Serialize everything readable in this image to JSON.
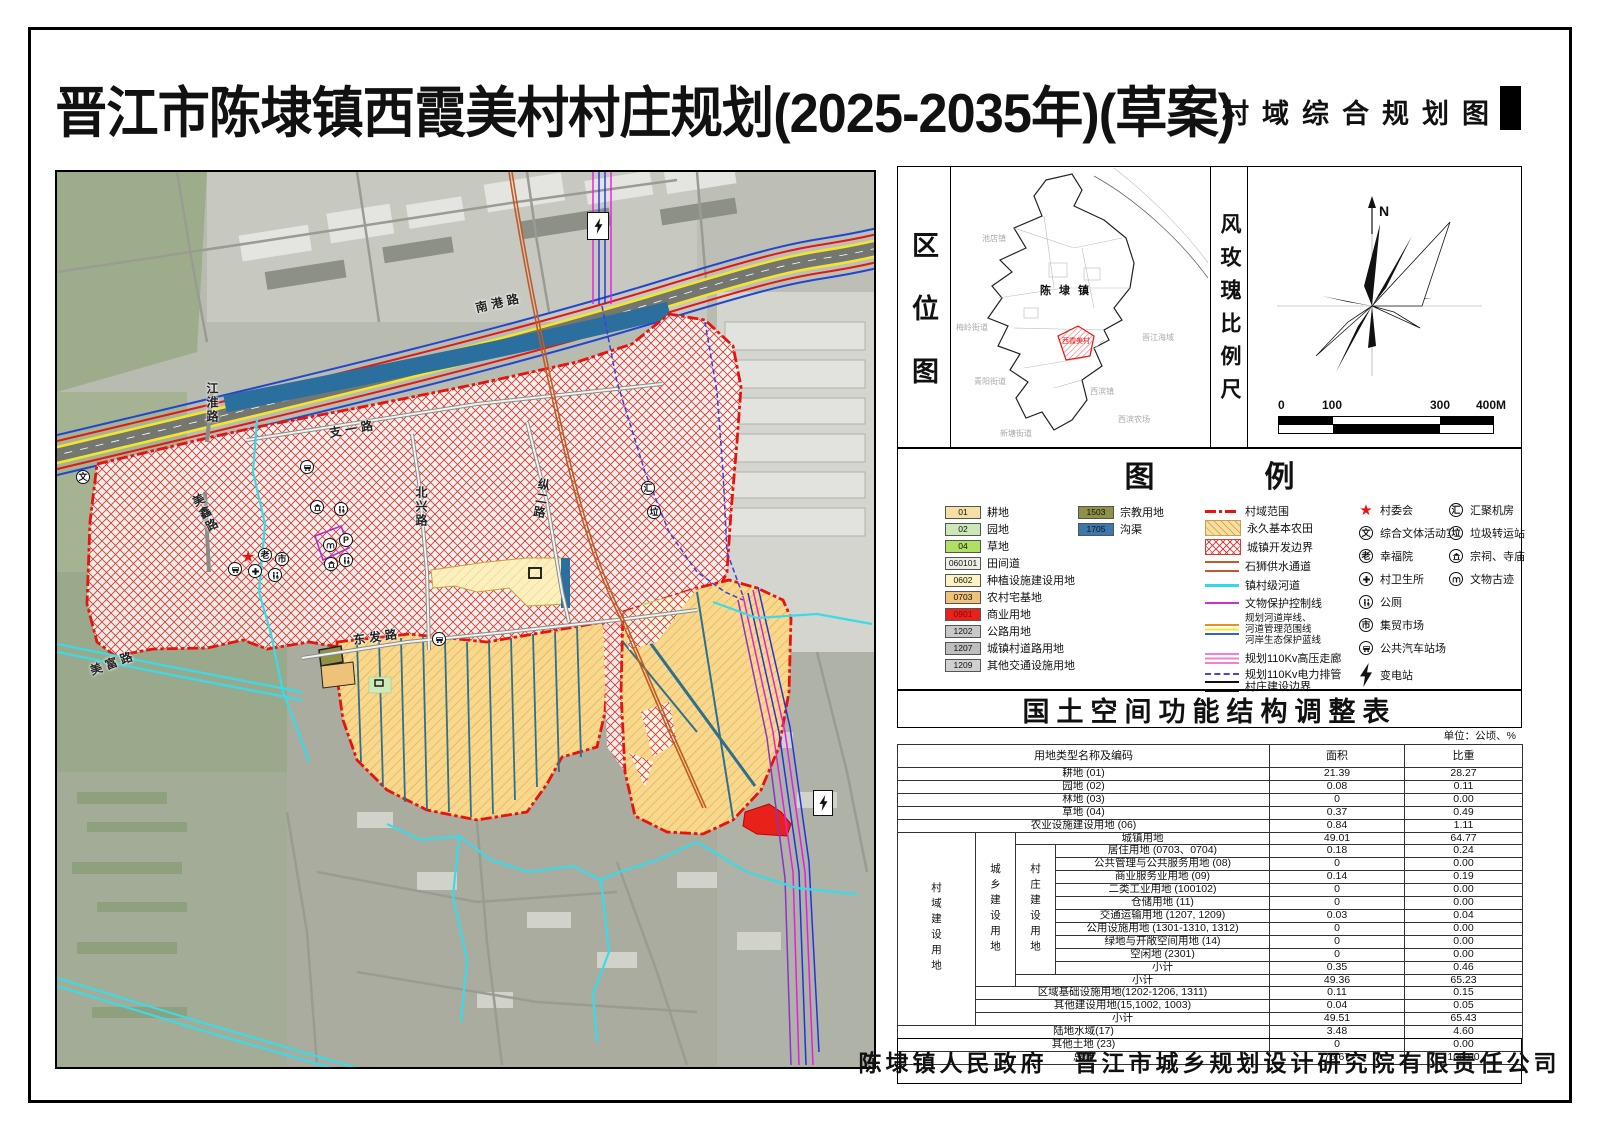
{
  "header": {
    "main_title": "晋江市陈埭镇西霞美村村庄规划(2025-2035年)(草案)",
    "sheet_title": "村域综合规划图"
  },
  "location_panel": {
    "label": "区位图",
    "town_label": "陈埭镇",
    "village_label": "西霞美村",
    "neighbors": [
      "池店镇",
      "梅岭街道",
      "青阳街道",
      "新塘街道",
      "西滨镇",
      "晋江海域",
      "西滨农场"
    ]
  },
  "compass_panel": {
    "label": "风玫瑰比例尺",
    "north_label": "N",
    "scale_ticks": [
      "0",
      "100",
      "300",
      "400M"
    ]
  },
  "legend": {
    "title": "图例",
    "land_items": [
      {
        "code": "01",
        "label": "耕地",
        "color": "#F6DFA4"
      },
      {
        "code": "02",
        "label": "园地",
        "color": "#CBE8B9"
      },
      {
        "code": "04",
        "label": "草地",
        "color": "#AFE065"
      },
      {
        "code": "060101",
        "label": "田间道",
        "color": "#EDEFE6"
      },
      {
        "code": "0602",
        "label": "种植设施建设用地",
        "color": "#FCF3C3"
      },
      {
        "code": "0703",
        "label": "农村宅基地",
        "color": "#EFC279"
      },
      {
        "code": "0901",
        "label": "商业用地",
        "color": "#E8211B",
        "text_color": "#7E0E08"
      },
      {
        "code": "1202",
        "label": "公路用地",
        "color": "#C8C8C8"
      },
      {
        "code": "1207",
        "label": "城镇村道路用地",
        "color": "#BEBEBE"
      },
      {
        "code": "1209",
        "label": "其他交通设施用地",
        "color": "#D0D0D0"
      }
    ],
    "land_items_2": [
      {
        "code": "1503",
        "label": "宗教用地",
        "color": "#8F9246"
      },
      {
        "code": "1705",
        "label": "沟渠",
        "color": "#3D78AD"
      }
    ],
    "line_items": [
      {
        "label": "村域范围"
      },
      {
        "label": "永久基本农田"
      },
      {
        "label": "城镇开发边界"
      },
      {
        "label": "石狮供水通道"
      },
      {
        "label": "镇村级河道"
      },
      {
        "label": "文物保护控制线"
      },
      {
        "label_l1": "规划河道岸线、",
        "label_l2": "河道管理范围线",
        "label_l3": "河岸生态保护蓝线"
      },
      {
        "label": "规划110Kv高压走廊"
      },
      {
        "label": "规划110Kv电力排管"
      },
      {
        "label": "村庄建设边界"
      }
    ],
    "point_items": [
      {
        "label": "村委会"
      },
      {
        "glyph": "文",
        "label": "综合文体活动室"
      },
      {
        "glyph": "老",
        "label": "幸福院"
      },
      {
        "label": "村卫生所"
      },
      {
        "label": "公厕"
      },
      {
        "glyph": "市",
        "label": "集贸市场"
      },
      {
        "label": "公共汽车站场"
      },
      {
        "label": "变电站"
      }
    ],
    "point_items_2": [
      {
        "glyph": "汇",
        "label": "汇聚机房"
      },
      {
        "glyph": "垃",
        "label": "垃圾转运站"
      },
      {
        "label": "宗祠、寺庙"
      },
      {
        "label": "文物古迹"
      }
    ]
  },
  "table": {
    "title": "国土空间功能结构调整表",
    "unit_note": "单位：公顷、%",
    "headers": {
      "name": "用地类型名称及编码",
      "area": "面积",
      "ratio": "比重"
    },
    "groups": {
      "g1": "村域建设用地",
      "g2": "城乡建设用地",
      "g3": "村庄建设用地"
    },
    "rows": [
      {
        "name": "耕地 (01)",
        "area": "21.39",
        "ratio": "28.27"
      },
      {
        "name": "园地 (02)",
        "area": "0.08",
        "ratio": "0.11"
      },
      {
        "name": "林地 (03)",
        "area": "0",
        "ratio": "0.00"
      },
      {
        "name": "草地 (04)",
        "area": "0.37",
        "ratio": "0.49"
      },
      {
        "name": "农业设施建设用地 (06)",
        "area": "0.84",
        "ratio": "1.11"
      },
      {
        "name": "城镇用地",
        "area": "49.01",
        "ratio": "64.77"
      },
      {
        "name": "居住用地 (0703、0704)",
        "area": "0.18",
        "ratio": "0.24"
      },
      {
        "name": "公共管理与公共服务用地 (08)",
        "area": "0",
        "ratio": "0.00"
      },
      {
        "name": "商业服务业用地 (09)",
        "area": "0.14",
        "ratio": "0.19"
      },
      {
        "name": "二类工业用地 (100102)",
        "area": "0",
        "ratio": "0.00"
      },
      {
        "name": "仓储用地 (11)",
        "area": "0",
        "ratio": "0.00"
      },
      {
        "name": "交通运输用地 (1207, 1209)",
        "area": "0.03",
        "ratio": "0.04"
      },
      {
        "name": "公用设施用地 (1301-1310, 1312)",
        "area": "0",
        "ratio": "0.00"
      },
      {
        "name": "绿地与开敞空间用地 (14)",
        "area": "0",
        "ratio": "0.00"
      },
      {
        "name": "空闲地 (2301)",
        "area": "0",
        "ratio": "0.00"
      },
      {
        "name": "小计",
        "area": "0.35",
        "ratio": "0.46"
      },
      {
        "name": "小计",
        "area": "49.36",
        "ratio": "65.23"
      },
      {
        "name": "区域基础设施用地(1202-1206, 1311)",
        "area": "0.11",
        "ratio": "0.15"
      },
      {
        "name": "其他建设用地(15,1002, 1003)",
        "area": "0.04",
        "ratio": "0.05"
      },
      {
        "name": "小计",
        "area": "49.51",
        "ratio": "65.43"
      },
      {
        "name": "陆地水域(17)",
        "area": "3.48",
        "ratio": "4.60"
      },
      {
        "name": "其他土地 (23)",
        "area": "0",
        "ratio": "0.00"
      },
      {
        "name": "总计",
        "area": "75.67",
        "ratio": "100.00"
      }
    ]
  },
  "footer": {
    "text": "陈埭镇人民政府　晋江市城乡规划设计研究院有限责任公司"
  },
  "map": {
    "road_labels": {
      "nangang": "南港路",
      "jianghuai": "江淮路",
      "zhiyi": "支一路",
      "beixing": "北兴路",
      "zonger": "纵二路",
      "dongfa": "东发路",
      "meixin": "美鑫路",
      "meifu": "美富路"
    },
    "icon_glyphs": {
      "wen": "文",
      "lao": "老",
      "shi": "市",
      "hui": "汇",
      "la": "垃",
      "p": "P",
      "star": "★"
    }
  },
  "colors": {
    "village_extent": "#E8130C",
    "urban_boundary_hatch": "#D93A30",
    "water_supply": "#C05A28",
    "town_river": "#35D8E8",
    "heritage_line": "#C435C9",
    "hv_corridor": "#F080D0",
    "power_duct": "#4444E0",
    "canal_water": "#2A6F9E",
    "commercial_red": "#E8211B",
    "farm_hatch_base": "#F8D88D"
  }
}
